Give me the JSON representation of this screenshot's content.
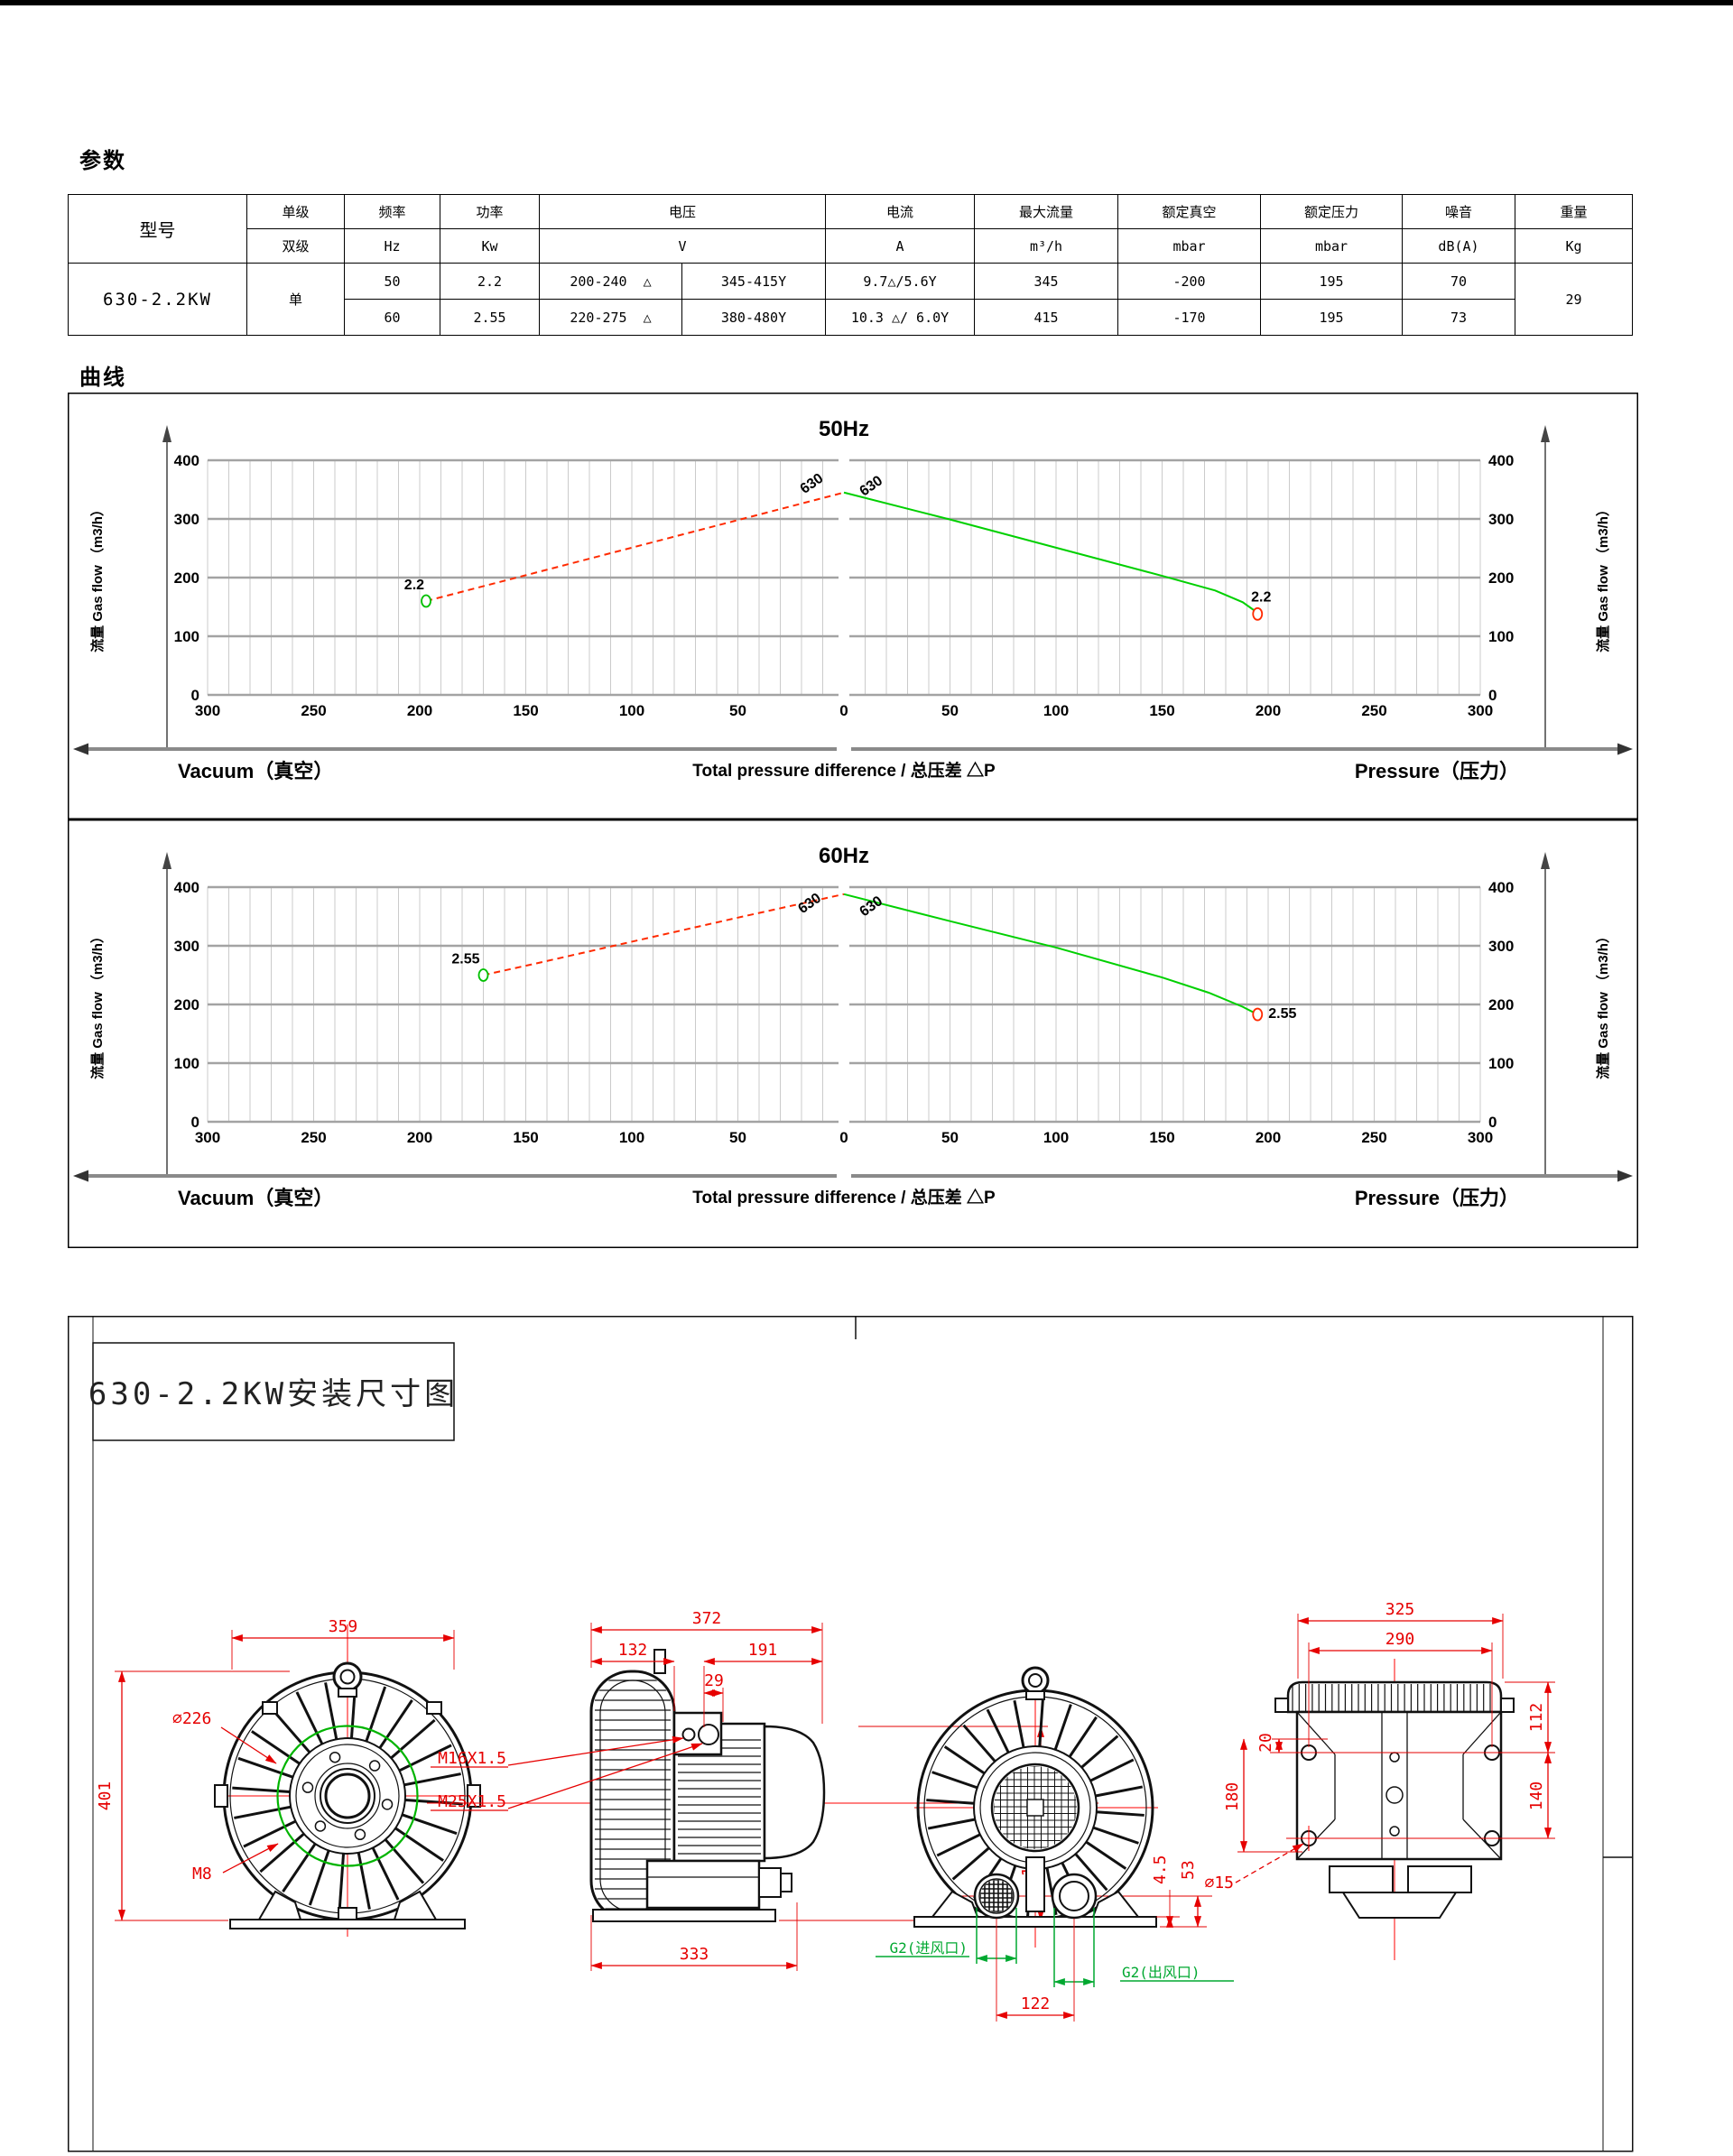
{
  "headings": {
    "params": "参数",
    "curves": "曲线"
  },
  "table": {
    "model_header": "型号",
    "model_value": "630-2.2KW",
    "stage_top": "单级",
    "stage_bottom": "双级",
    "stage_value": "单",
    "delta_symbol": "△",
    "cols": {
      "freq": {
        "name": "频率",
        "unit": "Hz"
      },
      "power": {
        "name": "功率",
        "unit": "Kw"
      },
      "voltage": {
        "name": "电压",
        "unit": "V"
      },
      "current": {
        "name": "电流",
        "unit": "A"
      },
      "maxflow": {
        "name": "最大流量",
        "unit": "m³/h"
      },
      "vacuum": {
        "name": "额定真空",
        "unit": "mbar"
      },
      "pressure": {
        "name": "额定压力",
        "unit": "mbar"
      },
      "noise": {
        "name": "噪音",
        "unit": "dB(A)"
      },
      "weight": {
        "name": "重量",
        "unit": "Kg"
      }
    },
    "rows": [
      {
        "hz": "50",
        "kw": "2.2",
        "v_delta": "200-240",
        "v_y": "345-415Y",
        "a": "9.7△/5.6Y",
        "flow": "345",
        "vac": "-200",
        "press": "195",
        "noise": "70"
      },
      {
        "hz": "60",
        "kw": "2.55",
        "v_delta": "220-275",
        "v_y": "380-480Y",
        "a": "10.3 △/ 6.0Y",
        "flow": "415",
        "vac": "-170",
        "press": "195",
        "noise": "73"
      }
    ],
    "weight_value": "29"
  },
  "chart_data": [
    {
      "type": "line",
      "title": "50Hz",
      "ylabel": "流量 Gas flow （m3/h）",
      "xlabel_left": "Vacuum（真空）",
      "xlabel_center": "Total pressure difference / 总压差 △P",
      "xlabel_right": "Pressure（压力）",
      "xlim": [
        -300,
        300
      ],
      "ylim": [
        0,
        400
      ],
      "x_tick_step": 50,
      "x_minor_step": 10,
      "y_tick_step": 100,
      "grid": true,
      "series": [
        {
          "name": "vacuum-curve",
          "color": "#ff2a00",
          "dashed": true,
          "points": [
            [
              -197,
              160
            ],
            [
              -150,
              204
            ],
            [
              -100,
              251
            ],
            [
              -50,
              298
            ],
            [
              0,
              345
            ]
          ],
          "marker": {
            "x": -197,
            "y": 160,
            "color": "#00c000",
            "label": "2.2",
            "ldx": -2,
            "ldy": -13,
            "lanchor": "end"
          }
        },
        {
          "name": "pressure-curve",
          "color": "#00d000",
          "dashed": false,
          "points": [
            [
              0,
              345
            ],
            [
              50,
              299
            ],
            [
              100,
              251
            ],
            [
              150,
              203
            ],
            [
              175,
              178
            ],
            [
              188,
              158
            ],
            [
              195,
              140
            ]
          ],
          "marker": {
            "x": 195,
            "y": 138,
            "color": "#ff2a00",
            "label": "2.2",
            "ldx": 4,
            "ldy": -14,
            "lanchor": "middle"
          }
        }
      ],
      "peak_labels": [
        {
          "text": "630",
          "x": -14,
          "y": 354
        },
        {
          "text": "630",
          "x": 14,
          "y": 350
        }
      ]
    },
    {
      "type": "line",
      "title": "60Hz",
      "ylabel": "流量 Gas flow （m3/h）",
      "xlabel_left": "Vacuum（真空）",
      "xlabel_center": "Total pressure difference / 总压差 △P",
      "xlabel_right": "Pressure（压力）",
      "xlim": [
        -300,
        300
      ],
      "ylim": [
        0,
        400
      ],
      "x_tick_step": 50,
      "x_minor_step": 10,
      "y_tick_step": 100,
      "grid": true,
      "series": [
        {
          "name": "vacuum-curve",
          "color": "#ff2a00",
          "dashed": true,
          "points": [
            [
              -170,
              250
            ],
            [
              -145,
              270
            ],
            [
              -100,
              307
            ],
            [
              -50,
              348
            ],
            [
              0,
              388
            ]
          ],
          "marker": {
            "x": -170,
            "y": 250,
            "color": "#00c000",
            "label": "2.55",
            "ldx": -4,
            "ldy": -13,
            "lanchor": "end"
          }
        },
        {
          "name": "pressure-curve",
          "color": "#00d000",
          "dashed": false,
          "points": [
            [
              0,
              388
            ],
            [
              50,
              342
            ],
            [
              100,
              297
            ],
            [
              150,
              246
            ],
            [
              172,
              220
            ],
            [
              188,
              196
            ],
            [
              195,
              183
            ]
          ],
          "marker": {
            "x": 195,
            "y": 183,
            "color": "#ff2a00",
            "label": "2.55",
            "ldx": 12,
            "ldy": 4,
            "lanchor": "start"
          }
        }
      ],
      "peak_labels": [
        {
          "text": "630",
          "x": -15,
          "y": 366
        },
        {
          "text": "630",
          "x": 14,
          "y": 361
        }
      ]
    }
  ],
  "drawing": {
    "title": "630-2.2KW安装尺寸图",
    "front": {
      "w": "359",
      "h": "401",
      "ring_dia": "∅226",
      "bolt": "M8"
    },
    "side": {
      "total": "372",
      "ring": "132",
      "motor": "191",
      "offset": "29",
      "gland_small": "M16X1.5",
      "gland_big": "M25X1.5",
      "top": "128",
      "bottom": "189",
      "base": "333"
    },
    "rear": {
      "inlet": "G2(进风口)",
      "outlet": "G2(出风口)",
      "spacing": "122",
      "plate": "4.5",
      "foot": "53"
    },
    "top": {
      "w": "325",
      "holes_w": "290",
      "h1": "112",
      "h2": "140",
      "edge": "20",
      "h3": "180",
      "hole_dia": "∅15"
    }
  }
}
